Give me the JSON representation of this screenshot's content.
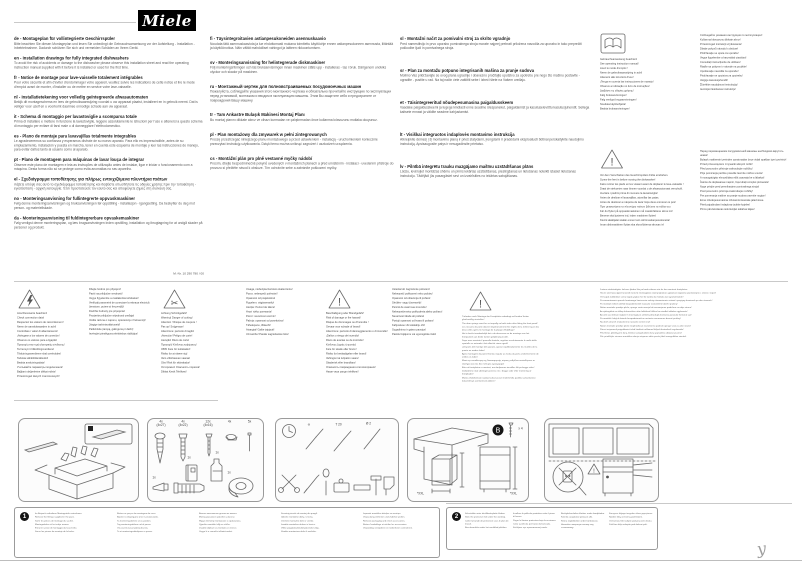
{
  "header": {
    "logo_text": "Miele",
    "doc_number": "M.-Nr. 10 290 780 / 00"
  },
  "glyphs": {
    "exclamation": "!",
    "scissors": "✂",
    "mark": "y"
  },
  "intro_columns": {
    "col1": [
      {
        "code": "de",
        "title": "Montageplan für vollintegrierte Geschirrspüler",
        "body": "Bitte beachten Sie diesen Montageplan und lesen Sie unbedingt die Gebrauchsanweisung vor der Aufstellung - Installation - Inbetriebnahme. Dadurch schützen Sie sich und vermeiden Schäden an Ihrem Gerät."
      },
      {
        "code": "en",
        "title": "Installation drawings for fully integrated dishwashers",
        "body": "To avoid the risk of accidents or damage to the dishwasher please observe this installation sheet and read the operating instruction manual supplied with it before it is installed or used for the first time."
      },
      {
        "code": "fr",
        "title": "Notice de montage pour lave-vaisselle totalement intégrables",
        "body": "Pour votre sécurité et afin d'éviter d'endommager votre appareil, veuillez suivre les indications de cette notice et lire le mode d'emploi avant de monter, d'installer ou de mettre en service votre lave-vaisselle."
      },
      {
        "code": "nl",
        "title": "Installatietekening voor volledig geïntegreerde afwasautomaten",
        "body": "Bekijk dit montageschema en lees de gebruiksaanwijzing voordat u uw apparaat plaatst, installeert en in gebruik neemt. Dat is veiliger voor uzelf en u voorkomt daarmee onnodige schade aan uw apparaat."
      },
      {
        "code": "it",
        "title": "Schema di montaggio per lavastoviglie a scomparsa totale",
        "body": "Prima di installare e mettere in funzione la lavastoviglie, leggere assolutamente le istruzioni per l'uso e attenersi a questo schema di montaggio per evitare di farsi male o di danneggiare l'elettrodomestico."
      },
      {
        "code": "es",
        "title": "Plano de montaje para lavavajillas totalmente integrables",
        "body": "Le agradeceremos su confianza y esperamos disfrute de su nuevo aparato. Para ello es imprescindible, antes de su emplazamiento, instalación y puesta en marcha, tener en cuenta este esquema de montaje y leer las instrucciones de manejo, para evitar daños tanto al usuario como al aparato."
      },
      {
        "code": "pt",
        "title": "Plano de montagem para máquinas de lavar louça de integrar",
        "body": "Observe este plano de montagem e leia as instruções de utilização antes de instalar, ligar e iniciar o funcionamento com a máquina. Desta forma não só se protege como evita anomalias no seu aparelho."
      },
      {
        "code": "el",
        "title": "Σχεδιάγραμμα τοποθέτησης για πλήρως εντοιχιζόμενα πλυντήρια πιάτων",
        "body": "Λάβετε υπόψη σας αυτό το σχεδιάγραμμα τοποθέτησης και διαβάστε οπωσδήποτε τις οδηγίες χρήσης πριν την τοποθέτηση - εγκατάσταση - αρχική λειτουργία. Έτσι προστατεύετε τον εαυτό σας και αποφεύγετε ζημιές στη συσκευή σας."
      },
      {
        "code": "no",
        "title": "Monteringsanvisning for fullintegrerte oppvaskmaskiner",
        "body": "Følg denne monteringsanvisningen og bruksanvisningen før oppstilling - installasjon - igangsetting. Da beskytter du deg mot person- og materiellskade."
      },
      {
        "code": "da",
        "title": "Monteringsanvisning til fuldintegrerbare opvaskemaskiner",
        "body": "Følg venligst denne monteringsplan, og læs brugsanvisningen inden opstilling, installation og ibrugtagning for at undgå skader på personer og produkt."
      }
    ],
    "col2": [
      {
        "code": "fi",
        "title": "Täysintegroitavien astianpesukoneiden asennuskaavio",
        "body": "Noudata tätä asennuskaaviota ja lue ehdottomasti mukana toimitettu käyttöohje ennen astianpesukoneen asennusta, liitäntää ja käyttöönottoa. Näin vältät mahdolliset vahingot ja laitteen rikkoontumisen."
      },
      {
        "code": "sv",
        "title": "Monteringsanvisning för helintegrerade diskmaskiner",
        "body": "Följ monteringsritningen och läs bruksanvisningen innan maskinen ställs upp - installeras - tas i bruk. Därigenom undviks olyckor och skador på maskinen."
      },
      {
        "code": "ru",
        "title": "Монтажный чертеж для полновстраиваемых посудомоечных машин",
        "body": "Пожалуйста, соблюдайте указания этого монтажного чертежа и обязательно прочитайте инструкцию по эксплуатации перед установкой, монтажом и вводом в эксплуатацию машины. Этим Вы защитите себя и предохраните от повреждения Вашу машину."
      },
      {
        "code": "tr",
        "title": "Tam Ankastre Bulaşık Makinesi Montaj Planı",
        "body": "Bu montaj planını dikkate alınız ve cihazı kurmadan ve çalıştırmadan önce kullanma kılavuzunu mutlaka okuyunuz."
      },
      {
        "code": "pl",
        "title": "Plan montażowy dla zmywarek w pełni zintegrowanych",
        "body": "Proszę przestrzegać niniejszego planu montażowego a przed ustawieniem - instalacją - uruchomieniem koniecznie przeczytać instrukcję użytkowania. Dzięki temu można uniknąć zagrożeń i uszkodzeń urządzenia."
      },
      {
        "code": "cs",
        "title": "Montážní plán pro plně vestavné myčky nádobí",
        "body": "Prosím, dbejte bezpodmínečně pokynů uvedených v montážních plánech a před umístěním - instalací - uvedením přístroje do provozu si přečtěte návod k obsluze. Tím ochráníte sebe a zabráníte poškození myčky."
      }
    ],
    "col3": [
      {
        "code": "sl",
        "title": "Montažni načrt za pomivalni stroj za skrito vgradnjo",
        "body": "Pred namestitvijo in prvo uporabo pomivalnega stroja morate najprej prebrati priložena navodila za uporabo in tako preprečiti poškodbe ljudi in pomivalnega stroja."
      },
      {
        "code": "sr",
        "title": "Plan za montažu potpuno integrisanih mašina za pranje sudova",
        "body": "Molimo Vas pridržavajte se ovog plana ugradnje i obavezno pročitajte uputstvo za upotrebu pre nego što mašinu postavite - ugradite - pustite u rad. Na taj način ćete zaštititi sebe i izbeći štete na Vašem uređaju."
      },
      {
        "code": "et",
        "title": "Täisintegreeritud nõudepesumasina paigaldusskeem",
        "body": "Vaadake paigaldusskeemi ja lugege kindlasti enne seadme ülespanekut, paigaldamist ja kasutuselevõttu kasutusjuhendit. Sellega kaitsete ennast ja väldite seadme kahjustamist."
      },
      {
        "code": "lt",
        "title": "Visiškai integruotos indaplovės montavimo instrukcija",
        "body": "Atkreipkite dėmesį į šį montavimo planą ir prieš statydami, įrengdami ir pradėdami eksploatuoti būtinai perskaitykite naudojimo instrukciją. Apsisaugosite patys ir nesugadinsite prietaiso."
      },
      {
        "code": "lv",
        "title": "Pilnībā integrētu trauku mazgājamo mašīnu uzstādīšanas plāns",
        "body": "Lūdzu, ievērojiet montāžas shēmu un pirms iekārtas uzstādīšanas, pieslēgšanas un lietošanas noteikti izlasiet lietošanas instrukciju. Tādējādi jūs pasargāsiet sevi un izvairīsities no iekārtas sabojāšanas."
      }
    ]
  },
  "manual_notice": {
    "left": [
      "Gebrauchsanweisung beachten!",
      "See operating instruction manual!",
      "Lisez le mode d'emploi !",
      "Neem de gebruiksaanwijzing in acht!",
      "Attenersi alle istruzioni d'uso!",
      "¡Tenga en cuenta las instrucciones de manejo!",
      "Observe a indicação no livro de instruções!",
      "Διαβάστε τις οδηγίες χρήσης!",
      "Følg bruksanvisningen!",
      "Følg venligst brugsanvisningen!",
      "Noudata käyttöohjetta!",
      "Beakta bruksanvisningen!"
    ],
    "right": [
      "Соблюдайте указания инструкции по эксплуатации!",
      "Kullanma kılavuzunu dikkate alınız!",
      "Przestrzegać instrukcji użytkowania!",
      "Dbejte pokynů návodu k obsluze!",
      "Pridržavajte se uputa za uporabu!",
      "Vegye figyelembe a használati utasítást!",
      "Consultați instrucțiunile de utilizare!",
      "Riaďte sa pokynmi v návode na použitie!",
      "Upoštevajte navodila za uporabo!",
      "Pridržavajte se uputstva za upotrebu!",
      "Järgige kasutusjuhendit!",
      "Žiūrėkite naudojimosi instrukciją!",
      "Ievērojiet lietošanas instrukciju!"
    ]
  },
  "feet_notice": {
    "left": [
      "Vor dem Verschieben des Geschirrspülers Füße eindrehen.",
      "Screw the feet in before moving the dishwasher!",
      "Faire rentrer les pieds en les vissant avant de déplacer le lave-vaisselle !",
      "Draai de stelvoeten naar binnen voordat u de afwasautomaat verschuift.",
      "Avvitare i piedini prima di muovere la lavastoviglie!",
      "Antes de deslizar el lavavajillas, atornillar las patas.",
      "Antes de deslocar a máquina de lavar loiça deve enroscar os pés!",
      "Πριν μετακινήσετε το πλυντήριο πιάτων βιδώστε τα πόδια του.",
      "Før du flytter på oppvaskmaskinen må maskinføttene skrus inn!",
      "Benene skal justeres ind, inden maskinen flyttes!",
      "Kierrä säätöjalat sisään ennen kuin siirrät astianpesukonetta!",
      "Innan diskmaskinen flyttas ska skruvfötterna skruvas in!"
    ],
    "right": [
      "Перед перемещением посудомоечной машины необходимо вкрутить ножки!",
      "Bulaşık makinesini yerinden oynatmadan önce vidalı ayakları içeri çeviriniz!",
      "Przed przesunięciem zmywarki wkręcić nóżki!",
      "Před posunutím přístroje zašroubujte nožičky!",
      "Prije pomicanja perilice posuđa zavrnite nožice unutra!",
      "A mosogatógép elmozdítása előtt csavarja be a lábakat!",
      "Înainte de deplasarea mașinii, înșurubați complet picioarele!",
      "Noge privijte pred premikanjem pomivalnega stroja!",
      "Pred posunutím prístroja zaskrutkujte nožičky!",
      "Pre pomeranja mašine za pranje sudova zavrnite nogice!",
      "Enne nõudepesumasina nihutamist keerake jalad sisse.",
      "Prieš pajudindami indaplovę įsukite kojeles!",
      "Pirms pārvietošanas ieskrūvējiet iekārtas kājas!"
    ]
  },
  "hazards": {
    "connection": {
      "left": [
        "Anschlusswerte beachten!",
        "Check connection data!",
        "Respectez les valeurs de raccordement !",
        "Neem de aansluitwaarden in acht!",
        "Controllare i valori di allacciamento!",
        "¡Aténgase a los valores de conexión!",
        "Observe os valores para a ligação!",
        "Προσοχή στην τιμή ηλεκτρικής σύνδεσης!",
        "Ta hensyn til tilkoblingsverdiene!",
        "Tilslutningsværdierne skal overholdes!",
        "Tarkista sähköliitäntätiedot!",
        "Beakta anslutningsdata!",
        "Учитывайте параметры подключения!",
        "Bağlantı değerlerine dikkat ediniz!",
        "Przestrzegać danych znamionowych!"
      ],
      "right": [
        "Dbejte hodnot pro připojení!",
        "Paziti na priključne vrednosti!",
        "Vegye figyelembe a csatlakozási értékeket!",
        "Verificați parametrii de conectare la rețeaua electrică (tensiune, putere și frecvență)!",
        "Dodržte hodnoty pre pripojenie!",
        "Provjerite priključne vrijednosti uređaja!",
        "Vodite računa o naponu, opterećenju i frekvenciji!",
        "Järgige tarbimisväärtuseid!",
        "Patikrinkite įtampą, galingumą ir dažnį!",
        "Ievērojiet pieslēguma elektriskos rādītājus!"
      ]
    },
    "cutting": {
      "left": [
        "Achtung Schnittgefahr!",
        "Warning! Danger of cutting!",
        "Attention ! Risque de coupure !",
        "Pas op! Snijgevaar!",
        "Attenzione: pericolo di taglio!",
        "¡Atención! Peligro de corte!",
        "Atenção! Risco de corte!",
        "Προσοχή! Κίνδυνος κοψίματος!",
        "OBS! Fare for kuttskader!",
        "Risiko for at skære sig!",
        "Varo viiltohaavan vaaraa!",
        "Obs! Risk för skärskador!",
        "Осторожно! Опасность порезов!",
        "Dikkat Kesik Tehlikesi!"
      ],
      "right": [
        "Uwaga, niebezpieczeństwo skaleczenia!",
        "Pozor, nebezpečí pořezání!",
        "Opasnost od posjekotina!",
        "Figyelem: vágásveszély!",
        "Atenție: Pericol de tăiere!",
        "Hrozí riziko porezania!",
        "Pozor: nevarnost ureznin!",
        "Pažnja: opasnost od posekotina!",
        "Tähelepanu, lõikeoht!",
        "Atsargiai! Galite įsipjauti!",
        "Uzmanību! Pastāv sagriešanās risks!"
      ]
    },
    "fire": {
      "left": [
        "Beschädigung oder Brandgefahr!",
        "Risk of damage or fire hazard!",
        "Risque de dommages ou d'incendie !",
        "Gevaar voor schade of brand!",
        "Attenzione: pericolo di danneggiamento o di incendio!",
        "¡Daños o riesgo de incendio!",
        "Risco de avarias ou de incêndio!",
        "Κίνδυνος ζημιάς ή φωτιάς!",
        "Fare for skade eller brann!",
        "Risiko for beskadigelse eller brand!",
        "Vahingon tai tulipalon vaara!",
        "Skaderisk eller brandfara!",
        "Опасность повреждения или возгорания!",
        "Hasar veya yangın tehlikesi!"
      ],
      "right": [
        "Usterka lub zagrożenie pożarem!",
        "Nebezpečí poškození nebo požáru!",
        "Opasnost od oštećenja ili požara!",
        "Sérülés- vagy tűzveszély!",
        "Pericol de avarii sau incendiu!",
        "Nebezpečenstvo poškodenia alebo požiaru!",
        "Nevarnost škode ali požara!",
        "Postoji opasnost od kvara ili požara!",
        "Kahjustuse või tulekahju oht!",
        "Sugadinimo ir gaisro pavojus!",
        "Pastāv bojājumu vai ugunsgrēka risks!"
      ]
    },
    "springs": {
      "left": [
        "Türfedern nach Montage der Frontplatte unbedingt auf beiden Seiten gleichmäßig einstellen!",
        "The door springs must be set equally on both sides after fitting the front panel!",
        "Les ressorts de porte doivent impérativement être réglés de la même façon des deux côtés après le montage de la plaque d'habillage !",
        "Het is beslist noodzakelijk dat u de deurveren na de montage van het frontpaneel aan beide kanten gelijkmatig instelt.",
        "Dopo aver montato il pannello frontale, regolare assolutamente le molle dello sportello su entrambi i lati affinché siano uguali!",
        "¡Después del montaje del aparato, ajustar equilibradamente los muelles de la puerta en ambos lados!",
        "Após montagem do painel frontal, regular as molas da porta uniformemente de ambos os lados!",
        "Μετά την τοποθέτηση της διακοσμητικής πόρτας ρυθμίζετε οπωσδήποτε τα ελατήρια και στις δύο πλευρές ομοιόμορφα!",
        "Etter at frontplaten er montert, må dørfjærene innstilles likt på begge sider!",
        "Dørfjedrene skal ubetinget justeres ens i begge sider efter montering af frontpladen!",
        "Muista ehdottomasti säätää luukun jouset molemmilta puolilta samanlaisiksi kalustelevyn asentamisen jälkeen!"
      ],
      "right": [
        "Justera nödvändigtvis luckans fjädrar lika på båda sidorna när du har monterat frontplåten.",
        "После монтажа фронтальной панели необходимо отрегулировать дверные пружины равномерно с обеих сторон!",
        "Ön kapak takıldıktan sonra kapak yayları her iki tarafta da mutlaka eşit ayarlanmalıdır!",
        "Po zamontowaniu panelu frontowego koniecznie należy równomiernie ustawić sprężyny drzwiczek po obu stronach!",
        "Po montáži čelních dvířek bezpodmínečně nastavte rovnoměrně dveřní pružiny!",
        "Nakon montaže prednje ploče, opruge vrata moraju biti ravnomjerno podešene na obje strane!",
        "Az ajtórugókat az előlap felszerelése után feltétlenül állítsa be mindkét oldalon egyformán!",
        "Arcurile ușii trebuie reglate în mod egal pe ambele părți după montarea panoului frontal al ușii!",
        "Po montáži čelných dvierok bezpodmienečne nastavte rovnomerne dverné pružiny!",
        "Na obeh straneh enakomerno nastavite vzmeti vrat!",
        "Nakon montaže prednje ploče neophodno je ravnomerno podesiti opruge vrata sa obe strane!",
        "Pärast esipaneeli paigaldamist tuleb kindlasti mõlemad küljed ühetaoliselt reguleerida!",
        "Pritvirtinus plokštę prie durų, būtinai sureguliuokite durų spyruokles abiejose pusėse!",
        "Pēc priekšējās virsmas montāžas durvju atsperes abās pusēs jābūt noregulētām vienādi."
      ]
    }
  },
  "panels": {
    "parts": {
      "labels": [
        "4x\n(4x27)",
        "4x\n(4x22)",
        "12x\n(4x16)",
        "4x",
        "5x",
        "1x",
        "1x",
        "1x",
        "1x"
      ]
    },
    "tools": {
      "labels": [
        "⊖",
        "T 20",
        "Ø 2"
      ]
    },
    "niche": {
      "badge": "B",
      "screw_count": "x 4",
      "size_left": "*XXL",
      "size_right": "*XXL"
    }
  },
  "steps": {
    "box1": {
      "badge": "1",
      "cols": [
        [
          "Im Beipack enthaltene Montageteile entnehmen.",
          "Remove the fittings supplied in the pack.",
          "Sortir les pièces de montage du sachet.",
          "Montagedelen uit het zakje nemen.",
          "Estrarre i pezzi di montaggio dal sacchetto.",
          "Sacar las piezas de montaje de la bolsa."
        ],
        [
          "Retirar as peças de montagem do saco.",
          "Βγάλτε τα εξαρτήματα από τη συσκευασία.",
          "Ta monteringsdelene ut av pakken.",
          "Tag monteringsdelene ud af posen.",
          "Ota asennusosat pakkauksesta.",
          "Ta ut monteringsdetaljerna ur påsen."
        ],
        [
          "Выньте монтажные детали из пакета.",
          "Montaj parçalarını paketten çıkarınız.",
          "Wyjąć elementy montażowe z opakowania.",
          "Vyjměte montážní díly ze sáčku.",
          "Izvadite dijelove za montažu iz vrećice.",
          "Vegye ki a szerelési alkatrészeket."
        ],
        [
          "Scoateți piesele de montaj din pungă.",
          "Vyberte montážne diely z vrecka.",
          "Vzemite montažne dele iz vrečke.",
          "Izvadite montažne delove iz kesice.",
          "Võtke paigaldusdetailid pakendist välja.",
          "Išimkite montavimo dalis iš maišelio."
        ],
        [
          "Izņemiet montāžas detaļas no maisiņa.",
          "Verpackung entfernen und Zubehör prüfen.",
          "Remove packaging and check accessories.",
          "Retirer l'emballage et vérifier les accessoires.",
          "Verpakking verwijderen en toebehoren controleren."
        ]
      ]
    },
    "box2": {
      "badge": "2",
      "cols": [
        [
          "Schutzfolie unter die Arbeitsplatte kleben.",
          "Stick the protective foil under the worktop.",
          "Coller la bande de protection sous le plan de travail.",
          "Beschermfolie onder het werkblad plakken."
        ],
        [
          "Incollare la pellicola protettiva sotto il piano di lavoro.",
          "Pegar la lámina protectora bajo la encimera.",
          "Colar a película por baixo da bancada.",
          "Κολλήστε την προστατευτική ταινία."
        ],
        [
          "Beskyttelsesfolien klæbes under bordpladen.",
          "Kiinnitä suojakalvo työtason alle.",
          "Klistra skyddsfolien under bänkskivan.",
          "Наклейте защитную пленку под столешницу."
        ],
        [
          "Koruyucu folyoyu tezgahın altına yapıştırınız.",
          "Nakleić folię ochronną pod blatem.",
          "Ochrannou fólii nalepte pod pracovní desku.",
          "Zaščitno folijo nalepite pod delovni pult."
        ]
      ]
    }
  },
  "footer": {
    "mark": "y"
  }
}
